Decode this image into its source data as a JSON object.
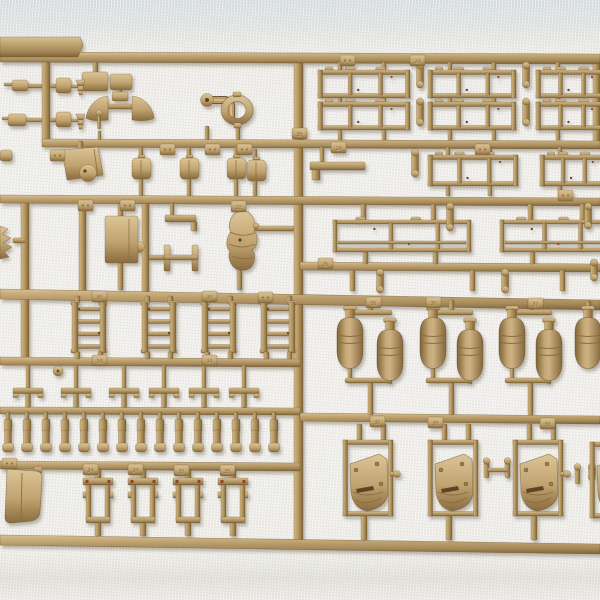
{
  "meta": {
    "subject": "tan plastic model-kit sprue (injection-moulded parts tree) photographed on white fabric",
    "visible_text_note": "only small embossed part numbers on runner tabs are visible",
    "visible_part_numbers": [
      "22",
      "24",
      "25",
      "30",
      "34",
      "35",
      "36",
      "37",
      "38"
    ]
  },
  "palette": {
    "plastic_light": "#dcc496",
    "plastic_mid": "#bfa370",
    "plastic_dark": "#8a6c3e",
    "plastic_edge": "#6f5530",
    "mark_dot": "#6b4a28",
    "paint_dot": "#93442a",
    "slot_dark": "#5f4526",
    "shadow": "#6a5d48",
    "bg_top": "#d7dee1",
    "bg_main": "#efeeea"
  },
  "scene": {
    "h_runners": [
      [
        0,
        52,
        600,
        10,
        2
      ],
      [
        42,
        139,
        558,
        8,
        2
      ],
      [
        0,
        195,
        600,
        8,
        3
      ],
      [
        300,
        262,
        300,
        8,
        2
      ],
      [
        0,
        289,
        600,
        10,
        11
      ],
      [
        0,
        357,
        300,
        8,
        2
      ],
      [
        0,
        407,
        300,
        7,
        1
      ],
      [
        300,
        413,
        300,
        8,
        3
      ],
      [
        0,
        461,
        300,
        8,
        2
      ],
      [
        0,
        535,
        600,
        10,
        9
      ]
    ],
    "v_runners": [
      [
        42,
        58,
        8,
        85
      ],
      [
        294,
        58,
        9,
        482
      ],
      [
        142,
        199,
        7,
        93
      ],
      [
        79,
        199,
        7,
        93
      ],
      [
        21,
        199,
        8,
        162
      ],
      [
        593,
        58,
        7,
        85
      ]
    ],
    "label_plate": [
      [
        0,
        37
      ],
      [
        80,
        37
      ],
      [
        83,
        45
      ],
      [
        78,
        57
      ],
      [
        0,
        57
      ]
    ],
    "posts_v": [
      [
        93,
        62,
        5,
        12
      ],
      [
        118,
        88,
        4,
        9
      ],
      [
        98,
        131,
        3,
        9
      ],
      [
        205,
        126,
        4,
        14
      ],
      [
        236,
        127,
        4,
        13
      ],
      [
        139,
        147,
        4,
        11
      ],
      [
        187,
        147,
        4,
        11
      ],
      [
        234,
        147,
        4,
        11
      ],
      [
        253,
        149,
        4,
        11
      ],
      [
        139,
        179,
        4,
        17
      ],
      [
        187,
        179,
        4,
        17
      ],
      [
        234,
        179,
        4,
        17
      ],
      [
        253,
        177,
        4,
        19
      ],
      [
        78,
        141,
        5,
        8
      ],
      [
        118,
        204,
        5,
        13
      ],
      [
        118,
        263,
        5,
        27
      ],
      [
        170,
        203,
        4,
        12
      ],
      [
        237,
        266,
        5,
        24
      ],
      [
        338,
        62,
        4,
        9
      ],
      [
        382,
        62,
        4,
        9
      ],
      [
        448,
        62,
        4,
        9
      ],
      [
        492,
        62,
        4,
        9
      ],
      [
        556,
        62,
        4,
        9
      ],
      [
        338,
        97,
        4,
        6
      ],
      [
        382,
        97,
        4,
        6
      ],
      [
        448,
        97,
        4,
        6
      ],
      [
        492,
        97,
        4,
        6
      ],
      [
        556,
        97,
        4,
        6
      ],
      [
        338,
        129,
        4,
        11
      ],
      [
        382,
        129,
        4,
        11
      ],
      [
        448,
        129,
        4,
        11
      ],
      [
        492,
        129,
        4,
        11
      ],
      [
        556,
        129,
        4,
        11
      ],
      [
        446,
        147,
        4,
        9
      ],
      [
        488,
        147,
        4,
        9
      ],
      [
        558,
        147,
        4,
        9
      ],
      [
        446,
        185,
        4,
        11
      ],
      [
        488,
        185,
        4,
        11
      ],
      [
        558,
        185,
        4,
        11
      ],
      [
        320,
        147,
        4,
        15
      ],
      [
        361,
        204,
        5,
        16
      ],
      [
        431,
        204,
        5,
        16
      ],
      [
        528,
        204,
        5,
        16
      ],
      [
        580,
        204,
        5,
        16
      ],
      [
        363,
        252,
        5,
        12
      ],
      [
        433,
        252,
        5,
        12
      ],
      [
        530,
        252,
        5,
        12
      ],
      [
        350,
        270,
        5,
        21
      ],
      [
        470,
        270,
        5,
        21
      ],
      [
        560,
        270,
        5,
        21
      ],
      [
        368,
        300,
        5,
        12
      ],
      [
        449,
        300,
        5,
        12
      ],
      [
        528,
        300,
        5,
        12
      ],
      [
        586,
        301,
        5,
        11
      ],
      [
        368,
        382,
        5,
        33
      ],
      [
        449,
        382,
        5,
        33
      ],
      [
        528,
        382,
        5,
        33
      ],
      [
        348,
        368,
        4,
        12
      ],
      [
        431,
        368,
        4,
        12
      ],
      [
        510,
        368,
        4,
        12
      ],
      [
        388,
        380,
        4,
        4
      ],
      [
        468,
        380,
        4,
        4
      ],
      [
        547,
        380,
        4,
        4
      ],
      [
        357,
        424,
        5,
        16
      ],
      [
        381,
        424,
        5,
        16
      ],
      [
        442,
        424,
        5,
        16
      ],
      [
        466,
        424,
        5,
        16
      ],
      [
        527,
        424,
        5,
        16
      ],
      [
        551,
        424,
        5,
        16
      ],
      [
        604,
        424,
        5,
        16
      ],
      [
        361,
        516,
        6,
        24
      ],
      [
        446,
        516,
        6,
        24
      ],
      [
        531,
        516,
        6,
        24
      ]
    ],
    "posts_h": [
      [
        28,
        84,
        14,
        4
      ],
      [
        26,
        118,
        16,
        4
      ],
      [
        50,
        84,
        6,
        4
      ],
      [
        50,
        118,
        6,
        4
      ],
      [
        71,
        85,
        7,
        3
      ],
      [
        71,
        119,
        7,
        3
      ],
      [
        106,
        104,
        28,
        5
      ],
      [
        149,
        255,
        15,
        5
      ],
      [
        254,
        226,
        40,
        5
      ],
      [
        13,
        238,
        12,
        5
      ],
      [
        34,
        467,
        8,
        6
      ]
    ],
    "tags": [
      [
        340,
        55,
        ""
      ],
      [
        410,
        55,
        "24"
      ],
      [
        50,
        150,
        ""
      ],
      [
        160,
        144,
        ""
      ],
      [
        205,
        144,
        ""
      ],
      [
        237,
        144,
        ""
      ],
      [
        331,
        142,
        "24"
      ],
      [
        475,
        144,
        ""
      ],
      [
        78,
        200,
        ""
      ],
      [
        120,
        200,
        ""
      ],
      [
        231,
        201,
        "22"
      ],
      [
        558,
        190,
        ""
      ],
      [
        292,
        128,
        "35"
      ],
      [
        318,
        258,
        "25"
      ],
      [
        92,
        291,
        "30"
      ],
      [
        202,
        291,
        "30"
      ],
      [
        258,
        292,
        ""
      ],
      [
        366,
        297,
        "36"
      ],
      [
        426,
        297,
        "36"
      ],
      [
        528,
        298,
        "37"
      ],
      [
        92,
        355,
        "34"
      ],
      [
        202,
        355,
        "34"
      ],
      [
        370,
        416,
        "36"
      ],
      [
        428,
        417,
        "38"
      ],
      [
        540,
        418,
        "38"
      ],
      [
        2,
        458,
        ""
      ],
      [
        83,
        464,
        "34"
      ],
      [
        128,
        464,
        "34"
      ],
      [
        174,
        465,
        "35"
      ],
      [
        220,
        465,
        "35"
      ]
    ],
    "g1_boxes": [
      [
        82,
        72,
        26,
        19
      ],
      [
        110,
        74,
        22,
        16
      ],
      [
        56,
        78,
        15,
        15
      ],
      [
        56,
        112,
        15,
        15
      ],
      [
        12,
        80,
        16,
        11
      ],
      [
        8,
        114,
        18,
        12
      ],
      [
        0,
        150,
        12,
        11
      ]
    ],
    "cones": [
      [
        76,
        80
      ],
      [
        76,
        114
      ]
    ],
    "fans": {
      "cy": 108,
      "lx": 108,
      "rx": 132,
      "top": 96,
      "bot": 120
    },
    "ball_pin": [
      99,
      113
    ],
    "door_plate": {
      "poly": [
        [
          62,
          150
        ],
        [
          98,
          147
        ],
        [
          103,
          175
        ],
        [
          67,
          180
        ]
      ],
      "disc": [
        88,
        173,
        8.5
      ],
      "dot": [
        85,
        171
      ]
    },
    "canteens": [
      [
        132,
        158
      ],
      [
        180,
        158
      ],
      [
        227,
        158
      ],
      [
        247,
        160
      ]
    ],
    "elbow": {
      "flange": [
        207,
        100,
        6.5
      ],
      "path": "M211,100 L224,100 Q231,100 231,107 L231,121",
      "tag": [
        200,
        128
      ]
    },
    "ring": {
      "cx": 237,
      "cy": 110,
      "ro": [
        16,
        15
      ],
      "ri": [
        9,
        8.5
      ]
    },
    "pbig": {
      "x": 105,
      "y": 216,
      "w": 33,
      "h": 47,
      "bump": [
        139,
        247,
        5.5
      ]
    },
    "lbracket": {
      "bar": [
        165,
        215,
        31,
        7
      ],
      "foot": [
        191,
        222,
        6,
        9
      ]
    },
    "hbeam": {
      "r1": [
        164,
        245,
        6,
        26
      ],
      "r2": [
        192,
        245,
        6,
        26
      ],
      "bar": [
        164,
        255,
        34,
        5
      ],
      "tag": [
        163,
        276
      ]
    },
    "tarp": {
      "x": 228,
      "y": 212,
      "dot": [
        240,
        240
      ]
    },
    "sprocket": "M0,226 L8,229 L2,234 L11,238 L3,243 L12,247 L4,252 L9,257 L0,259 Z",
    "shovel": {
      "body": "M7,469 L36,471 Q43,472 42,479 L40,511 Q40,519 31,521 L11,523 Q5,523 5,517 Z",
      "ridge": "M22,473 L21,519"
    },
    "disc_h5": [
      58,
      371,
      5
    ],
    "fence_frames": [
      [
        318,
        70,
        92,
        28
      ],
      [
        428,
        70,
        88,
        28
      ],
      [
        536,
        70,
        70,
        28
      ],
      [
        318,
        102,
        92,
        28
      ],
      [
        428,
        102,
        88,
        28
      ],
      [
        536,
        102,
        70,
        28
      ],
      [
        428,
        155,
        90,
        31
      ],
      [
        540,
        155,
        66,
        31
      ]
    ],
    "towbar": {
      "bar": [
        310,
        162,
        55,
        8
      ],
      "foot": [
        312,
        170,
        8,
        10
      ]
    },
    "fenders": [
      [
        333,
        220,
        138,
        32
      ],
      [
        500,
        220,
        106,
        32
      ]
    ],
    "pins": [
      [
        420,
        63,
        24
      ],
      [
        526,
        63,
        24
      ],
      [
        420,
        99,
        26
      ],
      [
        526,
        99,
        26
      ],
      [
        415,
        150,
        26
      ],
      [
        450,
        204,
        26
      ],
      [
        588,
        204,
        24
      ],
      [
        380,
        270,
        22
      ],
      [
        505,
        270,
        22
      ],
      [
        594,
        260,
        20
      ],
      [
        592,
        464,
        16
      ]
    ],
    "bombs": [
      [
        350,
        306
      ],
      [
        390,
        318
      ],
      [
        433,
        306
      ],
      [
        470,
        318
      ],
      [
        512,
        306
      ],
      [
        549,
        318
      ],
      [
        588,
        306
      ]
    ],
    "bomb_arms": [
      [
        348,
        310,
        44
      ],
      [
        429,
        310,
        44
      ],
      [
        508,
        310,
        44
      ],
      [
        345,
        378,
        46
      ],
      [
        426,
        378,
        46
      ],
      [
        505,
        378,
        46
      ]
    ],
    "ladders": [
      [
        72,
        302
      ],
      [
        142,
        302
      ],
      [
        202,
        302
      ],
      [
        261,
        302
      ]
    ],
    "tbars": [
      28,
      76,
      124,
      164,
      204,
      244
    ],
    "strips": [
      8,
      27,
      46,
      65,
      84,
      103,
      122,
      141,
      160,
      179,
      198,
      217,
      236,
      255,
      274
    ],
    "brackets": [
      [
        83,
        478
      ],
      [
        128,
        478
      ],
      [
        173,
        478
      ],
      [
        218,
        478
      ]
    ],
    "hatches": [
      [
        343,
        440
      ],
      [
        428,
        440
      ],
      [
        513,
        440
      ],
      [
        590,
        442
      ]
    ],
    "hatch_knobs": [
      0,
      2
    ],
    "dumbbells": [
      [
        497,
        470
      ]
    ],
    "half_pin": [
      575,
      468
    ]
  }
}
